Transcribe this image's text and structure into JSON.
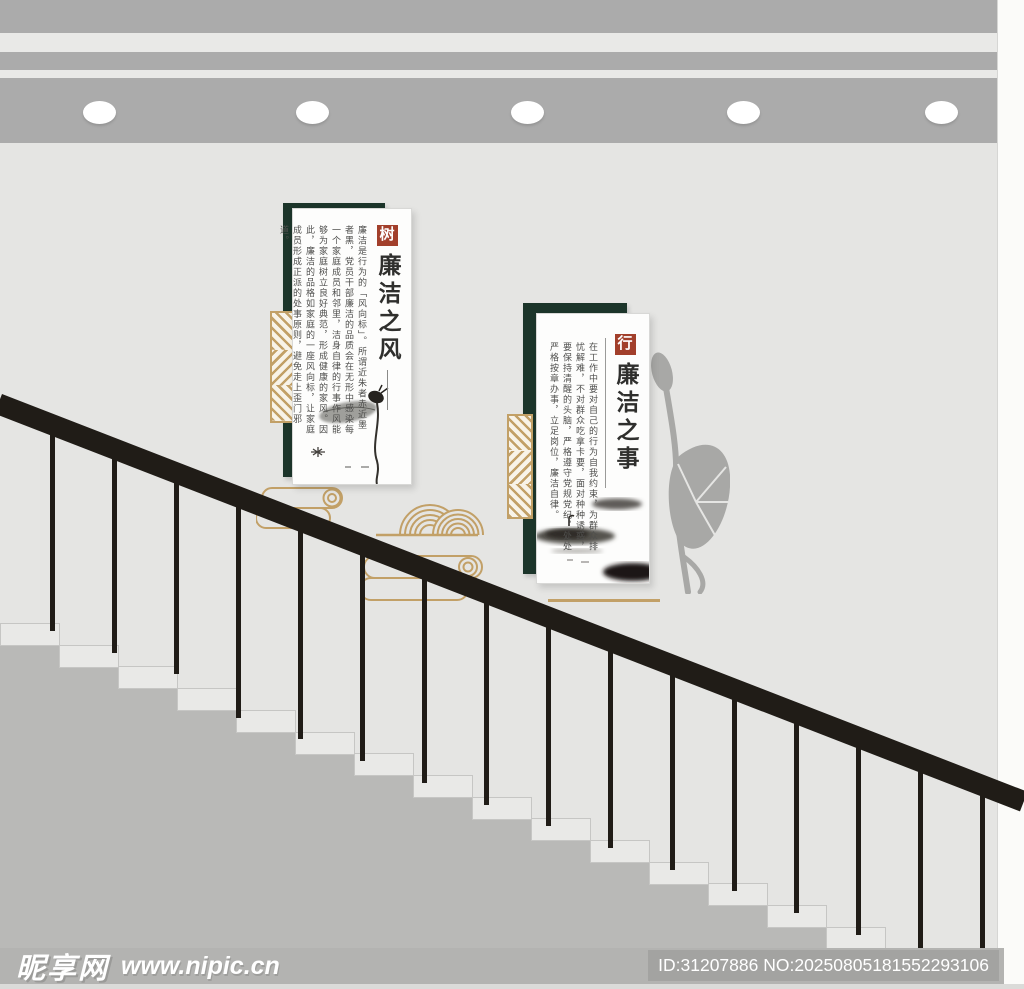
{
  "banners": [
    {
      "seal": "树",
      "title": "廉洁之风",
      "body": "廉洁是行为的「风向标」。所谓近朱者赤近墨者黑，党员干部廉洁的品质会在无形中感染每一个家庭成员和邻里，洁身自律的行事作风能够为家庭树立良好典范，形成健康的家风。因此，廉洁的品格如家庭的一座风向标，让家庭成员形成正派的处事原则，避免走上歪门邪道。"
    },
    {
      "seal": "行",
      "title": "廉洁之事",
      "body": "在工作中要对自己的行为自我约束，为群众排忧解难，不对群众吃拿卡要，面对种种诱惑，要保持清醒的头脑，严格遵守党规党纪，处处严格按章办事，立足岗位，廉洁自律。"
    }
  ],
  "watermark": {
    "site_name": "昵享网",
    "site_url": "www.nipic.cn",
    "image_id": "ID:31207886 NO:20250805181552293106"
  },
  "scene": {
    "ceiling_lights": 5,
    "balusters": 16,
    "steps": 17,
    "colors": {
      "gold": "#c2a067",
      "dark_green": "#1c352a",
      "seal_red": "#a23f2b",
      "railing_black": "#201c17",
      "wall_gray": "#e5e5e3",
      "ceiling_gray": "#ababab",
      "under_stair_gray": "#b9b9b7",
      "watermark_bar_gray": "#b3b3b1"
    }
  }
}
